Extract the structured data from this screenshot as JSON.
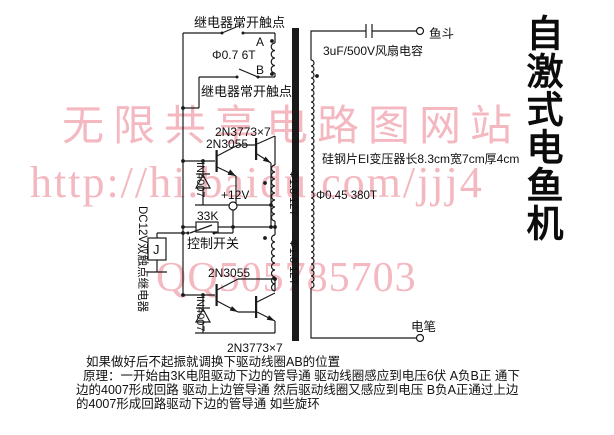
{
  "title": "自激式电鱼机",
  "watermarks": {
    "site": "无限共享电路图网站",
    "url": "http://hi.baidu.com/jjj4",
    "qq": "QQ505785703"
  },
  "colors": {
    "watermark": "#f4b8c0",
    "ink": "#1a1a1a"
  },
  "schematic": {
    "relay_contact_top": "继电器常开触点",
    "relay_contact_mid": "继电器常开触点",
    "point_a": "A",
    "point_b": "B",
    "feedback_coil": "Φ0.7 6T",
    "power_transistors_top": "2N3773×7",
    "driver_transistor_top": "2N3055",
    "diode_top": "IN4007",
    "supply": "+12V",
    "resistor": "33K",
    "control_switch": "控制开关",
    "relay": "DC12V双触点继电器",
    "relay_coil": "J",
    "driver_transistor_bottom": "2N3055",
    "diode_bottom": "IN4007",
    "power_transistors_bottom": "2N3773×7",
    "primary_top": "Φ1.8 12T",
    "primary_bottom": "Φ1.8 12T",
    "capacitor": "3uF/500V风扇电容",
    "terminal_fish_bucket": "鱼斗",
    "transformer_spec": "硅钢片EI变压器长8.3cm宽7cm厚4cm",
    "secondary": "Φ0.45 380T",
    "terminal_probe": "电笔"
  },
  "notes": {
    "line1": "如果做好后不起振就调换下驱动线圈AB的位置",
    "line2": "原理：一开始由3K电阻驱动下边的管导通 驱动线圈感应到电压6伏 A负B正 通下",
    "line3": "边的4007形成回路 驱动上边管导通 然后驱动线圈又感应到电压 B负A正通过上边",
    "line4": "的4007形成回路驱动下边的管导通 如些旋环"
  }
}
